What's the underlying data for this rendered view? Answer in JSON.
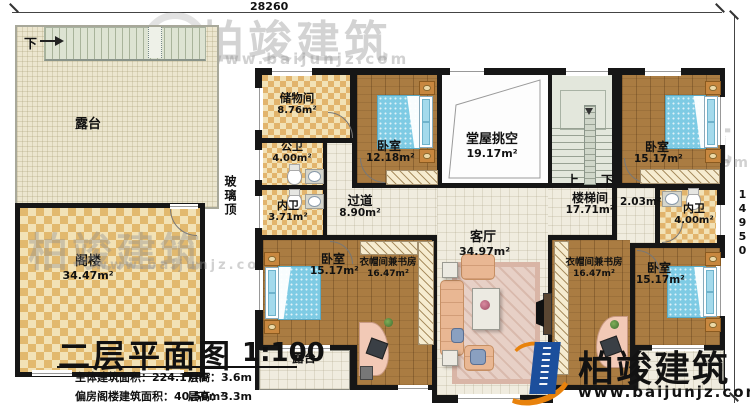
{
  "plan": {
    "dim_top": "28260",
    "dim_right": "14950",
    "glass_roof": "玻璃顶",
    "stairs_up": "上",
    "stairs_down": "下",
    "terrace_down": "下"
  },
  "rooms": [
    {
      "id": "terrace-top",
      "label": "露台",
      "area": ""
    },
    {
      "id": "attic",
      "label": "阁楼",
      "area": "34.47m²"
    },
    {
      "id": "storage",
      "label": "储物间",
      "area": "8.76m²"
    },
    {
      "id": "public-bath",
      "label": "公卫",
      "area": "4.00m²"
    },
    {
      "id": "inner-bath-left",
      "label": "内卫",
      "area": "3.71m²"
    },
    {
      "id": "bedroom-top",
      "label": "卧室",
      "area": "12.18m²"
    },
    {
      "id": "hall-void",
      "label": "堂屋挑空",
      "area": "19.17m²"
    },
    {
      "id": "stairwell",
      "label": "楼梯间",
      "area": "17.71m²"
    },
    {
      "id": "vestibule",
      "label": "",
      "area": "2.03m²"
    },
    {
      "id": "bedroom-top-right",
      "label": "卧室",
      "area": "15.17m²"
    },
    {
      "id": "inner-bath-right",
      "label": "内卫",
      "area": "4.00m²"
    },
    {
      "id": "corridor",
      "label": "过道",
      "area": "8.90m²"
    },
    {
      "id": "living",
      "label": "客厅",
      "area": "34.97m²"
    },
    {
      "id": "bedroom-bottom-left",
      "label": "卧室",
      "area": "15.17m²"
    },
    {
      "id": "cloak-study-left",
      "label": "衣帽间兼书房",
      "area": "16.47m²"
    },
    {
      "id": "cloak-study-right",
      "label": "衣帽间兼书房",
      "area": "16.47m²"
    },
    {
      "id": "bedroom-bottom-right",
      "label": "卧室",
      "area": "15.17m²"
    },
    {
      "id": "terrace-bottom",
      "label": "露台",
      "area": ""
    }
  ],
  "title_block": {
    "title": "二层平面图",
    "scale": "1:100",
    "rows": [
      {
        "label": "主体建筑面积：",
        "value": "224.17m²",
        "h_label": "层高：",
        "h_value": "3.6m"
      },
      {
        "label": "偏房阁楼建筑面积：",
        "value": "40.50m²",
        "h_label": "层高：",
        "h_value": "3.3m"
      }
    ]
  },
  "logo": {
    "name": "柏竣建筑",
    "url": "www.baijunjz.com"
  },
  "watermark": {
    "name": "柏竣建筑",
    "url": "www.baijunjz.com"
  },
  "colors": {
    "wall": "#161616",
    "wood": "#aa7c42",
    "tile": "#f0ecdf",
    "checker_light": "#f2e2b6",
    "checker_dark": "#e2b46c",
    "bed_blue": "#7ecbe4",
    "stairs": "#e3e7dc",
    "sofa": "#e9b793",
    "logo_blue": "#1c4f9c",
    "logo_orange": "#e8820c"
  }
}
